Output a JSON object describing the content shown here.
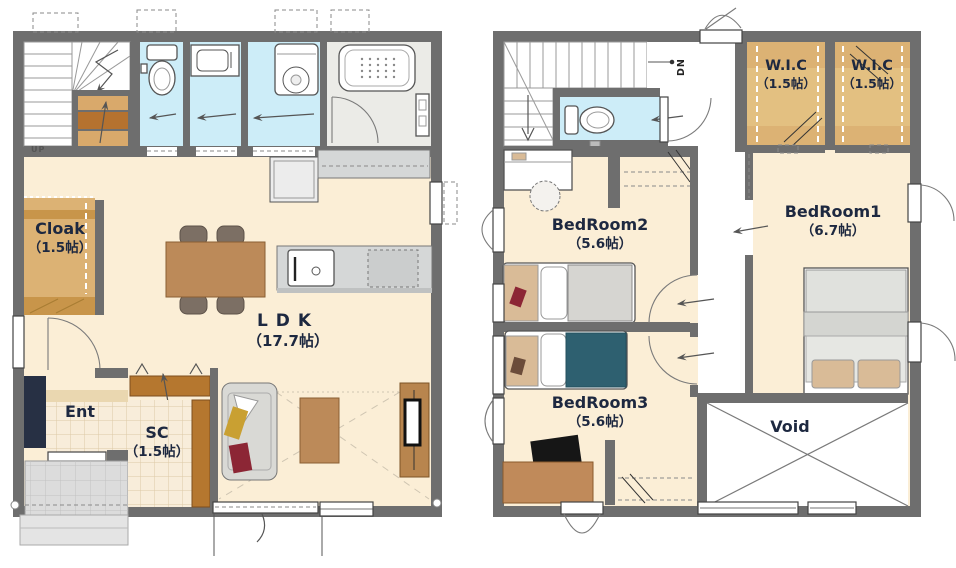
{
  "document": {
    "type": "floor-plan",
    "floor_count": 2
  },
  "floor1": {
    "rooms": {
      "ldk": {
        "label": "LDK",
        "area": "（17.7帖）"
      },
      "cloak": {
        "label": "Cloak",
        "area": "（1.5帖）"
      },
      "ent": {
        "label": "Ent"
      },
      "sc": {
        "label": "SC",
        "area": "（1.5帖）"
      }
    },
    "stairs": {
      "label": "UP"
    }
  },
  "floor2": {
    "rooms": {
      "bedroom1": {
        "label": "BedRoom1",
        "area": "（6.7帖）"
      },
      "bedroom2": {
        "label": "BedRoom2",
        "area": "（5.6帖）"
      },
      "bedroom3": {
        "label": "BedRoom3",
        "area": "（5.6帖）"
      },
      "wic_left": {
        "label": "W.I.C",
        "area": "（1.5帖）"
      },
      "wic_right": {
        "label": "W.I.C",
        "area": "（1.5帖）"
      },
      "void": {
        "label": "Void"
      }
    },
    "stairs": {
      "label": "DN"
    }
  },
  "colors": {
    "wall": "#6e6e6e",
    "floor": "#fbeed6",
    "water": "#cdedf8",
    "bath": "#ebebe7",
    "tan": "#dcb274",
    "tand": "#c8954a",
    "wood": "#bc8a59",
    "woodd": "#b5772f",
    "counter": "#d5d7d7",
    "navy": "#273044",
    "teal": "#2e6070",
    "sofa": "#d9d9d5",
    "porch": "#dcdcdc",
    "tile": "#f8edda",
    "ink": "#1d2840"
  }
}
